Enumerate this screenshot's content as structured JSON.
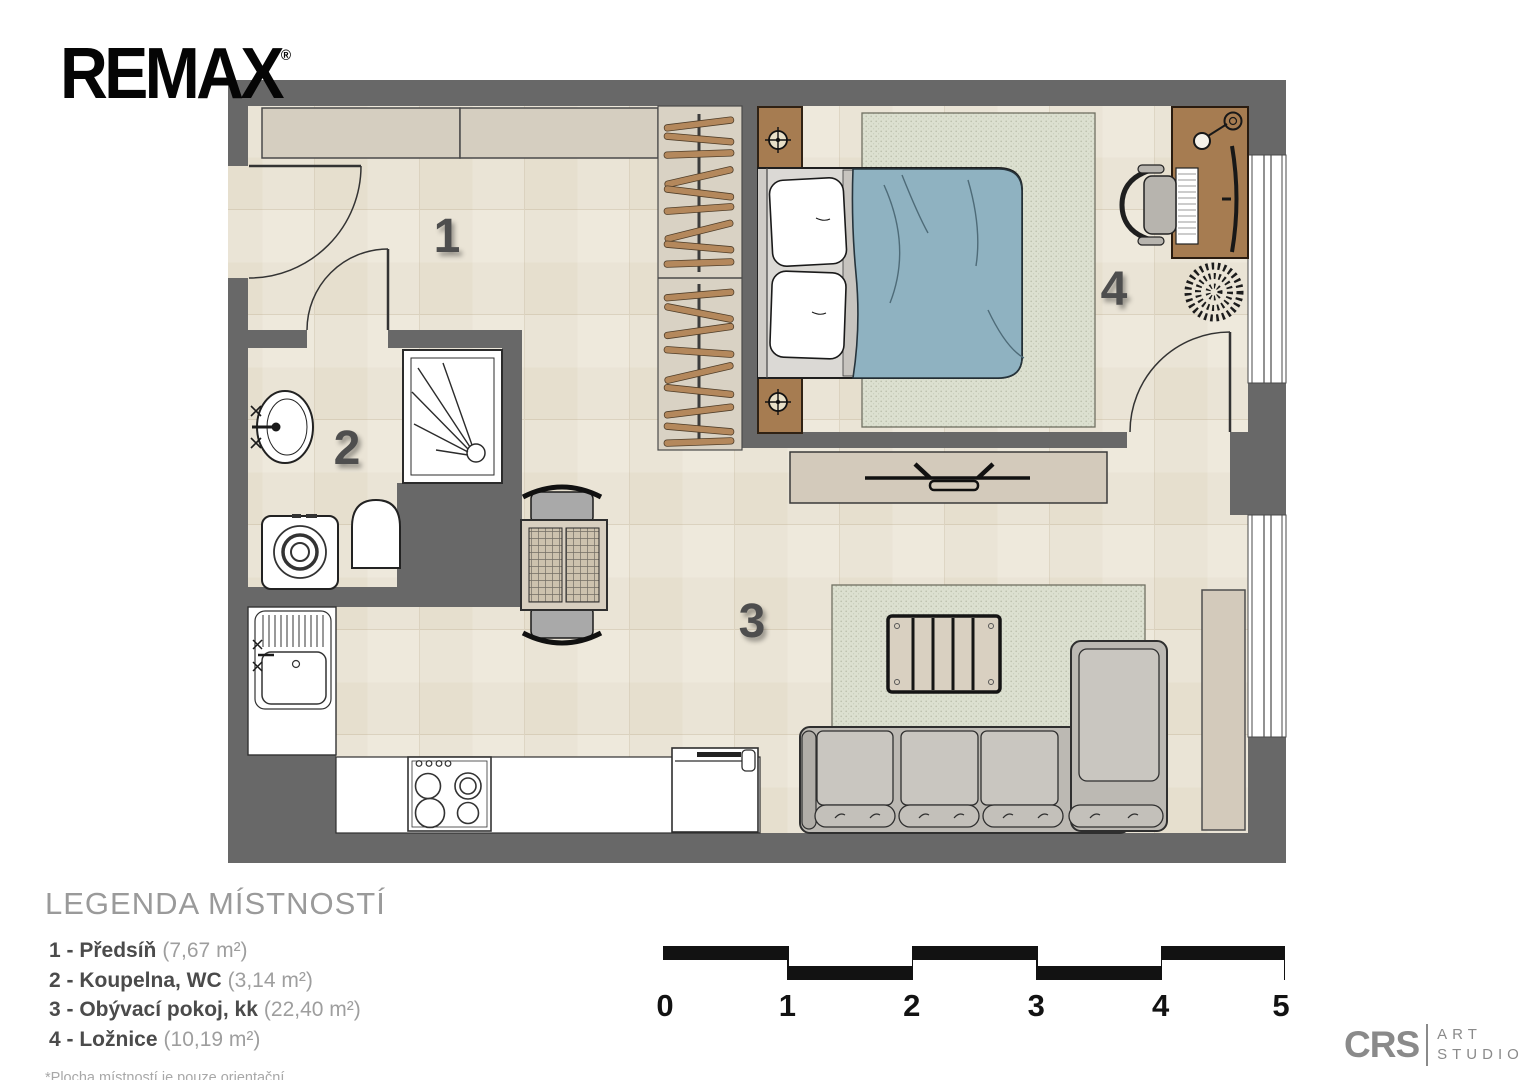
{
  "branding": {
    "logo_text": "REMAX",
    "registered_mark": "®"
  },
  "plan": {
    "rooms": [
      {
        "number": "1",
        "name": "Předsíň"
      },
      {
        "number": "2",
        "name": "Koupelna, WC"
      },
      {
        "number": "3",
        "name": "Obývací pokoj, kk"
      },
      {
        "number": "4",
        "name": "Ložnice"
      }
    ]
  },
  "legend": {
    "title": "LEGENDA MÍSTNOSTÍ",
    "items": [
      {
        "label": "1 - Předsíň",
        "area": "(7,67 m²)"
      },
      {
        "label": "2 - Koupelna, WC",
        "area": "(3,14 m²)"
      },
      {
        "label": "3 - Obývací pokoj, kk",
        "area": "(22,40 m²)"
      },
      {
        "label": "4 - Ložnice",
        "area": "(10,19 m²)"
      }
    ],
    "footnote": "*Plocha místností je pouze orientační"
  },
  "scale_bar": {
    "labels": [
      "0",
      "1",
      "2",
      "3",
      "4",
      "5"
    ]
  },
  "studio_logo": {
    "abbr": "CRS",
    "line1": "ART",
    "line2": "STUDIO"
  },
  "colors": {
    "wall": "#686868",
    "floor": "#eae4d6",
    "cabinet": "#d5cec0",
    "rug": "#dce0d0",
    "wood": "#a67c51",
    "blanket": "#8fb2c1",
    "scale_black": "#121212"
  }
}
